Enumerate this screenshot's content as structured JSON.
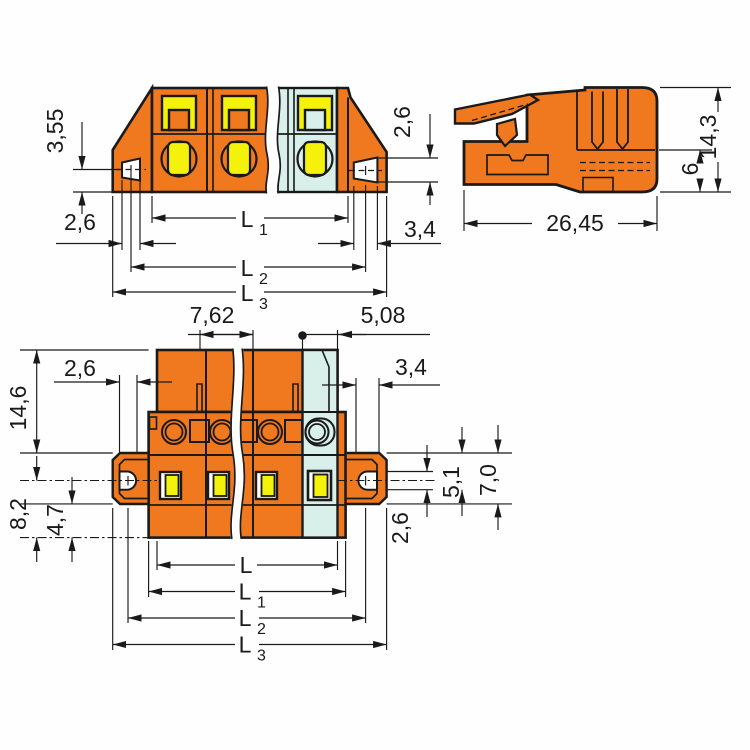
{
  "drawing": {
    "type": "technical-dimension-drawing",
    "subject": "pluggable-terminal-block-connector-with-mounting-flanges",
    "colors": {
      "body_orange": "#F0781E",
      "end_module_blue": "#D8EFEA",
      "contact_yellow": "#F4F20A",
      "line": "#1A1A1A",
      "background": "#FEFEFE"
    },
    "views": {
      "front": {
        "name": "front-section-view",
        "dims": {
          "hole_height": "3,55",
          "slot_width_left": "2,6",
          "slot_height_right": "2,6",
          "slot_width_right": "3,4",
          "L": "L",
          "s1": "1",
          "s2": "2",
          "s3": "3"
        }
      },
      "side": {
        "name": "side-view",
        "dims": {
          "total_width": "26,45",
          "total_height": "14,3",
          "lower_height": "6"
        }
      },
      "bottom": {
        "name": "bottom-view",
        "dims": {
          "pitch": "7,62",
          "end_pitch": "5,08",
          "slot_width_left": "2,6",
          "slot_width_right": "3,4",
          "body_height": "14,6",
          "hole_center_to_bottom": "8,2",
          "flange_to_bottom": "4,7",
          "flange_slot_depth": "5,1",
          "flange_height": "7,0",
          "slot_height_right": "2,6",
          "L": "L",
          "s1": "1",
          "s2": "2",
          "s3": "3"
        }
      }
    }
  }
}
